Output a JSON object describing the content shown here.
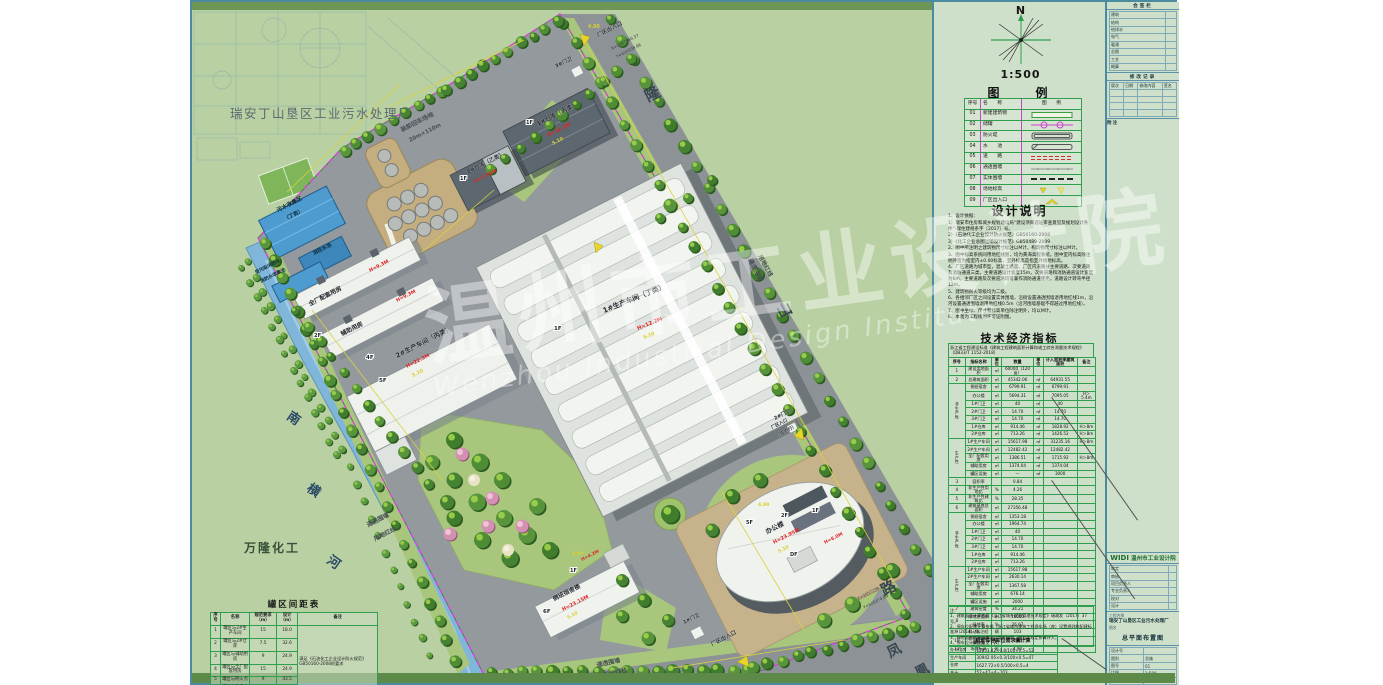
{
  "plan": {
    "plant_title": "瑞安丁山垦区工业污水处理厂",
    "adjacent_factory": "万隆化工",
    "loading_l1": "装卸回车场地",
    "loading_l2": "20m×110m",
    "roads": {
      "longshan": [
        "隆",
        "山",
        "路"
      ],
      "fenghuang": [
        "凤",
        "凰"
      ]
    },
    "river": [
      "南",
      "横",
      "河"
    ],
    "pools": {
      "sewage_l1": "污水收集区",
      "sewage_l2": "（丁类）",
      "fire": "消防水池",
      "cont_l1": "受污染消防水",
      "cont_l2": "消防水收集池"
    },
    "buildings": {
      "workshop1": {
        "label": "1#生产车间（丁类）",
        "h": "H=12.2M"
      },
      "workshop2": {
        "label": "2#生产车间（丙类）",
        "h": "H=22.3M"
      },
      "warehouse1": {
        "label": "1#仓库（丙类）",
        "h": "H=12.2M"
      },
      "warehouse2": {
        "label": "2#仓库（乙类）",
        "h": "H=7.95M"
      },
      "support": {
        "label": "全厂配套用房",
        "h": "H=9.3M"
      },
      "aux": {
        "label": "辅助用房",
        "h": "H=9.3M"
      },
      "dorm": {
        "label": "倒班宿舍楼",
        "h": "H=23.15M",
        "h2": "H=4.2M"
      },
      "office": {
        "label": "办公楼",
        "h": "H=23.95M",
        "h2": "H=6.0M"
      }
    },
    "gates": {
      "g1": "1#门卫",
      "g2": "2#门卫",
      "g3": "3#门卫"
    },
    "entrances": {
      "top": "厂区出入口",
      "bottom": "厂区出入口",
      "right1": "厂区入口",
      "right2": "（仅人行）"
    },
    "fence": {
      "l1": "通透围墙",
      "l2": "用地红线"
    },
    "coords": {
      "t1": "X=3067560.37",
      "t2": "Y=520339.96",
      "b1": "X=3057239.76",
      "b2": "Y=520374.69"
    },
    "tags": {
      "f1": "1F",
      "f2": "2F",
      "f4": "4F",
      "f5": "5F",
      "f6": "6F",
      "df": "DF"
    },
    "elev": {
      "e490": "4.90",
      "e510": "5.10"
    }
  },
  "watermark": {
    "cn": "温州市工业设计院",
    "en": "Wenzhou Industrial Design Institute"
  },
  "spacing_table": {
    "title": "罐区间距表",
    "headers": [
      "序号",
      "名称",
      "规范要求（m）",
      "设计（m）",
      "备注"
    ],
    "rows": [
      [
        "1",
        "罐区与2#生产车间",
        "15",
        "18.0",
        {
          "t": "满足《石油化工企业设计防火规范》GB50160-2008的要求",
          "rs": 6,
          "cls": "rk"
        }
      ],
      [
        "2",
        "罐区与2#仓库",
        "7.5",
        "32.6"
      ],
      [
        "3",
        "罐区与辅助用房",
        "9",
        "24.9"
      ],
      [
        "4",
        "罐区与全厂配套用房",
        "15",
        "24.9"
      ],
      [
        "5",
        "罐区与明火点",
        "9",
        "43.5"
      ],
      [
        "6",
        "罐区与厂内主要道路",
        "10",
        "10"
      ]
    ]
  },
  "panel": {
    "north_label": "N",
    "scale": "1:500",
    "legend_title": "图　　例",
    "legend_headers": [
      "序号",
      "名　　称",
      "图　　例"
    ],
    "legend_rows": [
      [
        "01",
        "新建建筑物"
      ],
      [
        "02",
        "储罐"
      ],
      [
        "03",
        "防火堤"
      ],
      [
        "04",
        "水　　池"
      ],
      [
        "05",
        "道　　路"
      ],
      [
        "06",
        "通透围墙"
      ],
      [
        "07",
        "实体围墙"
      ],
      [
        "08",
        "场地标高"
      ],
      [
        "09",
        "厂区出入口"
      ]
    ],
    "notes_title": "设计说明",
    "notes": [
      "1、设计依据：",
      "1）瑞安市住房和城乡规划建设局“建设项目选址审查意见及规划设计条件”-瑞住建规条字〔2017〕号。",
      "2）《石油化工企业设计防火规范》GB50160-2008",
      "3）《化工企业总图运输设计规范》GB50489-2009",
      "2、图中所注明之建筑物尺寸标注以M计，构筑物尺寸标注以M计。",
      "3、图中标高系统同用地红线图，均为黄海高程系统。图中室内标高除注明外皆为指室内±0.00标高，室外标高是指室外场地标高。",
      "4、厂区道路为城市型，混凝土路面。厂区内道路分主要道路、次要道路及消防通道三类，主要道路设计宽度15m，次要道路和消防通道设计宽度为6m。主要道路及次要道路均可兼作消防通道使用，道路设计转弯半径12m。",
      "5、建筑物耐火等级均为二级。",
      "6、各相邻厂区之间设置实体围墙，沿街设置通透围墙退用地红线1m，沿河设置通透围墙退用地红线0.5m（沿河围墙基础不得越过用地红线）。",
      "7、图中坐标、尺寸和标高单位除注明外，均以M计。",
      "8、本图为工程规划许可证附图。"
    ],
    "tei_title": "技术经济指标",
    "tei_standard": "浙江省工程建设标准《建筑工程建筑面积计算和竣工综合测量技术规程》（DB33/T 1152-2018）",
    "tei_headers": [
      "序号",
      "指标名称",
      "单位",
      "数量",
      "单位",
      "计入容积率建筑面积",
      "备注"
    ],
    "tei_rows": [
      [
        "1",
        "建设用地面积",
        "㎡",
        "60000（120亩）",
        "",
        "",
        ""
      ],
      [
        "2",
        "总建筑面积",
        "㎡",
        "45342.06",
        "㎡",
        "64931.55",
        ""
      ],
      [
        {
          "t": "非生产性",
          "rs": 7,
          "cls": "vert"
        },
        "倒班宿舍",
        "㎡",
        "6799.91",
        "㎡",
        "6799.91",
        ""
      ],
      [
        null,
        "办公楼",
        "㎡",
        "5694.31",
        "㎡",
        "7095.05",
        "H＞5.4m"
      ],
      [
        null,
        "1#门卫",
        "㎡",
        "40",
        "㎡",
        "40",
        ""
      ],
      [
        null,
        "2#门卫",
        "㎡",
        "14.70",
        "㎡",
        "14.70",
        ""
      ],
      [
        null,
        "3#门卫",
        "㎡",
        "14.70",
        "㎡",
        "14.70",
        ""
      ],
      [
        null,
        "1#仓库",
        "㎡",
        "914.46",
        "㎡",
        "1828.92",
        "H＞8m"
      ],
      [
        null,
        "2#仓库",
        "㎡",
        "713.26",
        "㎡",
        "1426.52",
        "H＞8m"
      ],
      [
        {
          "t": "生产性",
          "rs": 5,
          "cls": "vert"
        },
        "1#生产车间",
        "㎡",
        "15617.98",
        "㎡",
        "31235.16",
        "H＞8m"
      ],
      [
        null,
        "2#生产车间",
        "㎡",
        "12482.42",
        "㎡",
        "12482.42",
        ""
      ],
      [
        null,
        "全厂配套用房",
        "㎡",
        "1386.51",
        "㎡",
        "1715.92",
        "H＞8m"
      ],
      [
        null,
        "辅助用房",
        "㎡",
        "1374.04",
        "㎡",
        "1374.04",
        ""
      ],
      [
        null,
        "罐区设施",
        "㎡",
        "—",
        "㎡",
        "3000",
        ""
      ],
      [
        "3",
        "容积率",
        "",
        "0.84",
        "",
        "",
        ""
      ],
      [
        "4",
        "非生产性用地比",
        "%",
        "4.26",
        "",
        "",
        ""
      ],
      [
        "5",
        "非生产性建筑比",
        "%",
        "28.35",
        "",
        "",
        ""
      ],
      [
        "6",
        "建筑基底总面积",
        "㎡",
        "27356.48",
        "",
        "",
        ""
      ],
      [
        {
          "t": "非生产性",
          "rs": 7,
          "cls": "vert"
        },
        "倒班宿舍",
        "㎡",
        "1353.18",
        "",
        "",
        ""
      ],
      [
        null,
        "办公楼",
        "㎡",
        "1964.74",
        "",
        "",
        ""
      ],
      [
        null,
        "1#门卫",
        "㎡",
        "40",
        "",
        "",
        ""
      ],
      [
        null,
        "2#门卫",
        "㎡",
        "14.70",
        "",
        "",
        ""
      ],
      [
        null,
        "3#门卫",
        "㎡",
        "14.70",
        "",
        "",
        ""
      ],
      [
        null,
        "1#仓库",
        "㎡",
        "914.46",
        "",
        "",
        ""
      ],
      [
        null,
        "2#仓库",
        "㎡",
        "713.26",
        "",
        "",
        ""
      ],
      [
        {
          "t": "生产性",
          "rs": 5,
          "cls": "vert"
        },
        "1#生产车间",
        "㎡",
        "15617.98",
        "",
        "",
        ""
      ],
      [
        null,
        "2#生产车间",
        "㎡",
        "2630.14",
        "",
        "",
        ""
      ],
      [
        null,
        "全厂配套用房",
        "㎡",
        "1367.58",
        "",
        "",
        ""
      ],
      [
        null,
        "辅助用房",
        "㎡",
        "676.14",
        "",
        "",
        ""
      ],
      [
        null,
        "罐区设施",
        "㎡",
        "2000",
        "",
        "",
        ""
      ],
      [
        "7",
        "建筑密度",
        "%",
        "34.21",
        "",
        "",
        ""
      ],
      [
        {
          "t": "8",
          "rs": 2
        },
        "绿地总面积",
        "㎡",
        "16000",
        "",
        "",
        ""
      ],
      [
        null,
        "绿地率",
        "%",
        "26.67",
        "",
        "",
        ""
      ],
      [
        "9",
        "机动车泊位",
        "辆",
        "103",
        "",
        "",
        ""
      ],
      [
        "10",
        "非机动车停放数量",
        "辆",
        "200",
        "",
        "",
        ""
      ],
      [
        "11",
        "场地标高",
        "米",
        "4.90",
        "",
        "",
        ""
      ]
    ],
    "tei_notes": [
      "注：",
      "1、建筑面积计算依据《浙江省城乡规划管理技术规定》瑞政发〔2017〕37号。",
      "2、停车位配建计算依据《浙江省城市建筑工程停车场（库）设置规则和配建标准》〔2014〕号。",
      "3、绿地面积含屋顶绿化及零星绿地，按相关规定折算计入。",
      "4、停车位计算方法见下表。"
    ],
    "parking_title": "机动车停车位需求量计算",
    "parking_rows": [
      [
        "办公用房",
        "12853.42×0.8/100×0.5=52"
      ],
      [
        "生产车间",
        "30942.95×0.3/100×0.5=47"
      ],
      [
        "仓库",
        "1627.72×0.5/100×0.5=4"
      ],
      [
        "合计",
        "52+47+4=103"
      ]
    ]
  },
  "titleblock": {
    "block1_title": "会签栏",
    "block1_rows": [
      [
        "建筑",
        ""
      ],
      [
        "结构",
        ""
      ],
      [
        "给排水",
        ""
      ],
      [
        "电气",
        ""
      ],
      [
        "暖通",
        ""
      ],
      [
        "总图",
        ""
      ],
      [
        "工艺",
        ""
      ],
      [
        "概算",
        ""
      ]
    ],
    "block2_title": "修改记录",
    "block2_headers": [
      "版次",
      "日期",
      "修改内容",
      "签名"
    ],
    "block3_title": "附注",
    "logo_mark": "WIDI",
    "company": "温州市工业设计院",
    "sign_rows": [
      [
        "审定",
        ""
      ],
      [
        "审核",
        ""
      ],
      [
        "项目负责人",
        ""
      ],
      [
        "专业负责人",
        ""
      ],
      [
        "校对",
        ""
      ],
      [
        "设计",
        ""
      ]
    ],
    "project_label": "工程名称",
    "project": "瑞安丁山垦区工业污水处理厂",
    "drawing_label": "图名",
    "drawing": "总平面布置图",
    "meta_rows": [
      [
        "设计号",
        ""
      ],
      [
        "图别",
        "总施"
      ],
      [
        "图号",
        "01"
      ],
      [
        "比例",
        "1:500"
      ],
      [
        "日期",
        ""
      ]
    ]
  }
}
